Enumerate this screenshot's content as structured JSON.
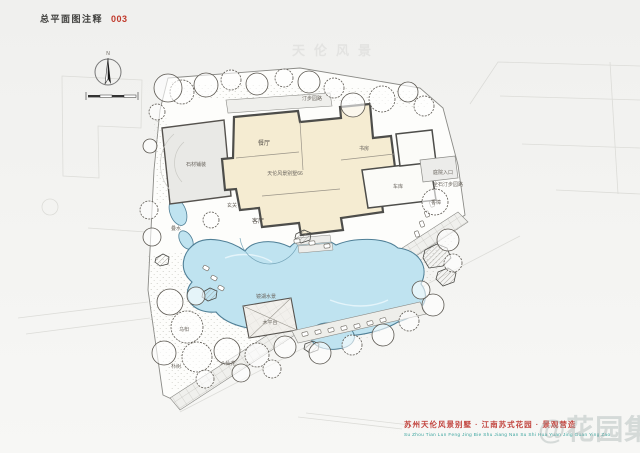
{
  "header": {
    "title": "总平面图注释",
    "sheet_number": "003"
  },
  "compass": {
    "north_label": "N"
  },
  "watermarks": {
    "plan_center": "天伦风景",
    "brand": "@花园集"
  },
  "footer": {
    "title_cn": "苏州天伦风景别墅 · 江南苏式花园 · 景观营造",
    "title_pinyin": "Su Zhou Tian Lun Feng Jing Bie Shu Jiang Nan Su Shi Hua Yuan Jing Guan Ying Zao"
  },
  "plan": {
    "building": {
      "name": "天伦风景别墅66",
      "rooms": {
        "dining": "餐厅",
        "living": "客厅",
        "foyer": "玄关",
        "study": "书房",
        "garage": "车库"
      }
    },
    "features": {
      "terrace": "石材铺装",
      "top_path": "汀步园路",
      "entrance": "庭院入口",
      "entrance_path": "全石汀步园路",
      "pond": "镜湖水景",
      "deck": "木平台",
      "cascade": "叠水"
    },
    "plants": {
      "camphor": "香樟",
      "tallow": "乌桕",
      "hackberry": "朴树",
      "hydrangea": "八仙花"
    }
  },
  "colors": {
    "accent_red": "#c0392b",
    "teal": "#38a39d",
    "pond_fill": "#bfe3f0",
    "building_fill": "#f5ecd2",
    "wall": "#4d4d4a"
  }
}
